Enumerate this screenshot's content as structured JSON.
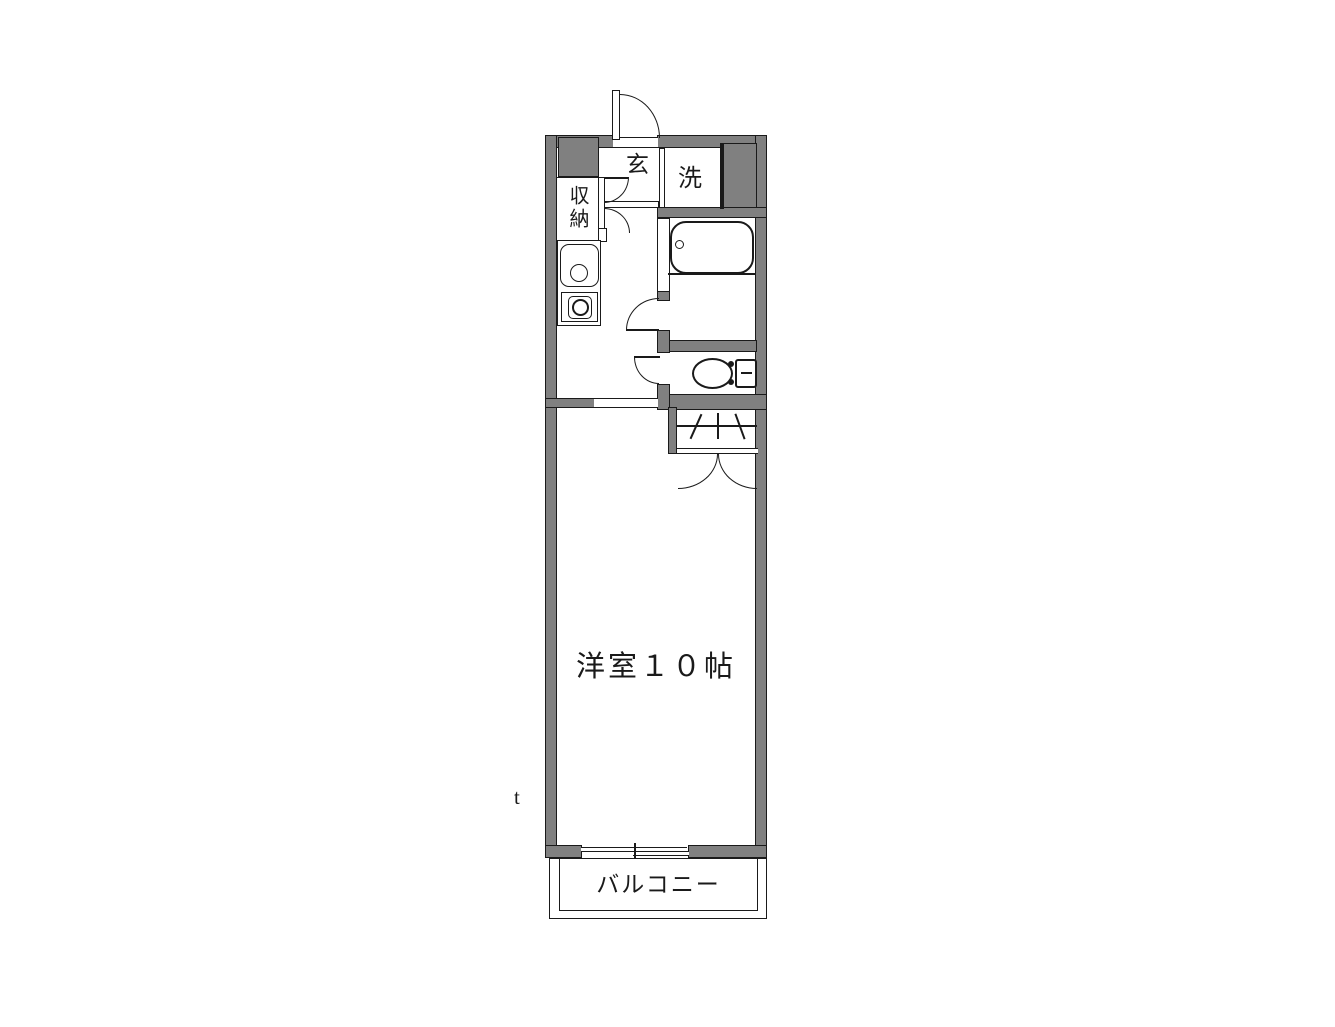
{
  "plan": {
    "labels": {
      "entrance": "玄",
      "laundry": "洗",
      "storage": "収納",
      "main_room": "洋室１０帖",
      "balcony": "バルコニー"
    },
    "stray_mark": "t",
    "colors": {
      "wall_fill": "#808080",
      "line": "#1a1a1a",
      "background": "#ffffff"
    },
    "fixtures": {
      "bathtub": "bathtub-icon",
      "toilet": "toilet-icon",
      "sink": "kitchen-sink-icon",
      "stove": "stove-burner-icon",
      "closet": "closet-hanger-icon",
      "entrance_door": "swing-door-icon",
      "balcony_window": "sliding-window-icon"
    }
  }
}
